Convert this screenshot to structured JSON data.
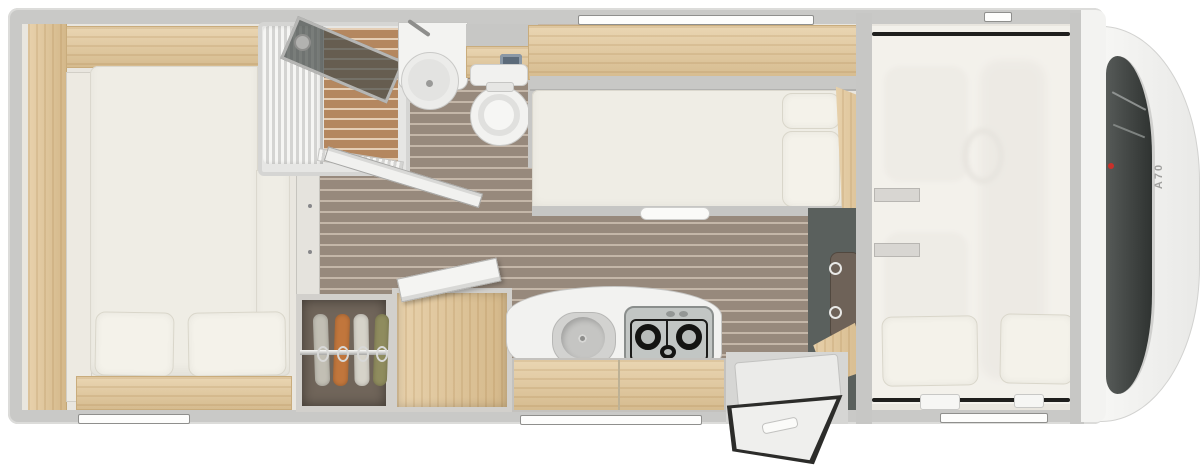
{
  "model": {
    "label": "A70"
  },
  "brand_dot_color": "#c8302a",
  "palette": {
    "wall": "#c9c9c7",
    "interior_floor": "#e9e6df",
    "corridor_floor": "#97897c",
    "shower_floor": "#b4875f",
    "furniture_wood": "#e4ca9d",
    "mattress": "#efede5",
    "entry_mat": "#5a605d",
    "windshield": "#3c403e"
  },
  "rooms": {
    "rear_bedroom": {
      "name": "rear double bed",
      "pillows": 2
    },
    "bathroom": {
      "fixtures": [
        "shower",
        "washbasin",
        "toilet"
      ]
    },
    "wardrobe": {
      "garments": 4,
      "garment_colors": [
        "#c2bfb4",
        "#c1763c",
        "#d6d3c9",
        "#8f8c5e"
      ]
    },
    "kitchen": {
      "fixtures": [
        "fridge",
        "sink",
        "gas hob"
      ],
      "hob_burners": 3
    },
    "side_bed": {
      "pillows": 2
    },
    "entrance": {
      "door_state": "open"
    },
    "alcove_bed": {
      "pillows": 2
    },
    "cab": {
      "windshield": true,
      "hood_label": "A70"
    }
  },
  "windows_visible": 5
}
